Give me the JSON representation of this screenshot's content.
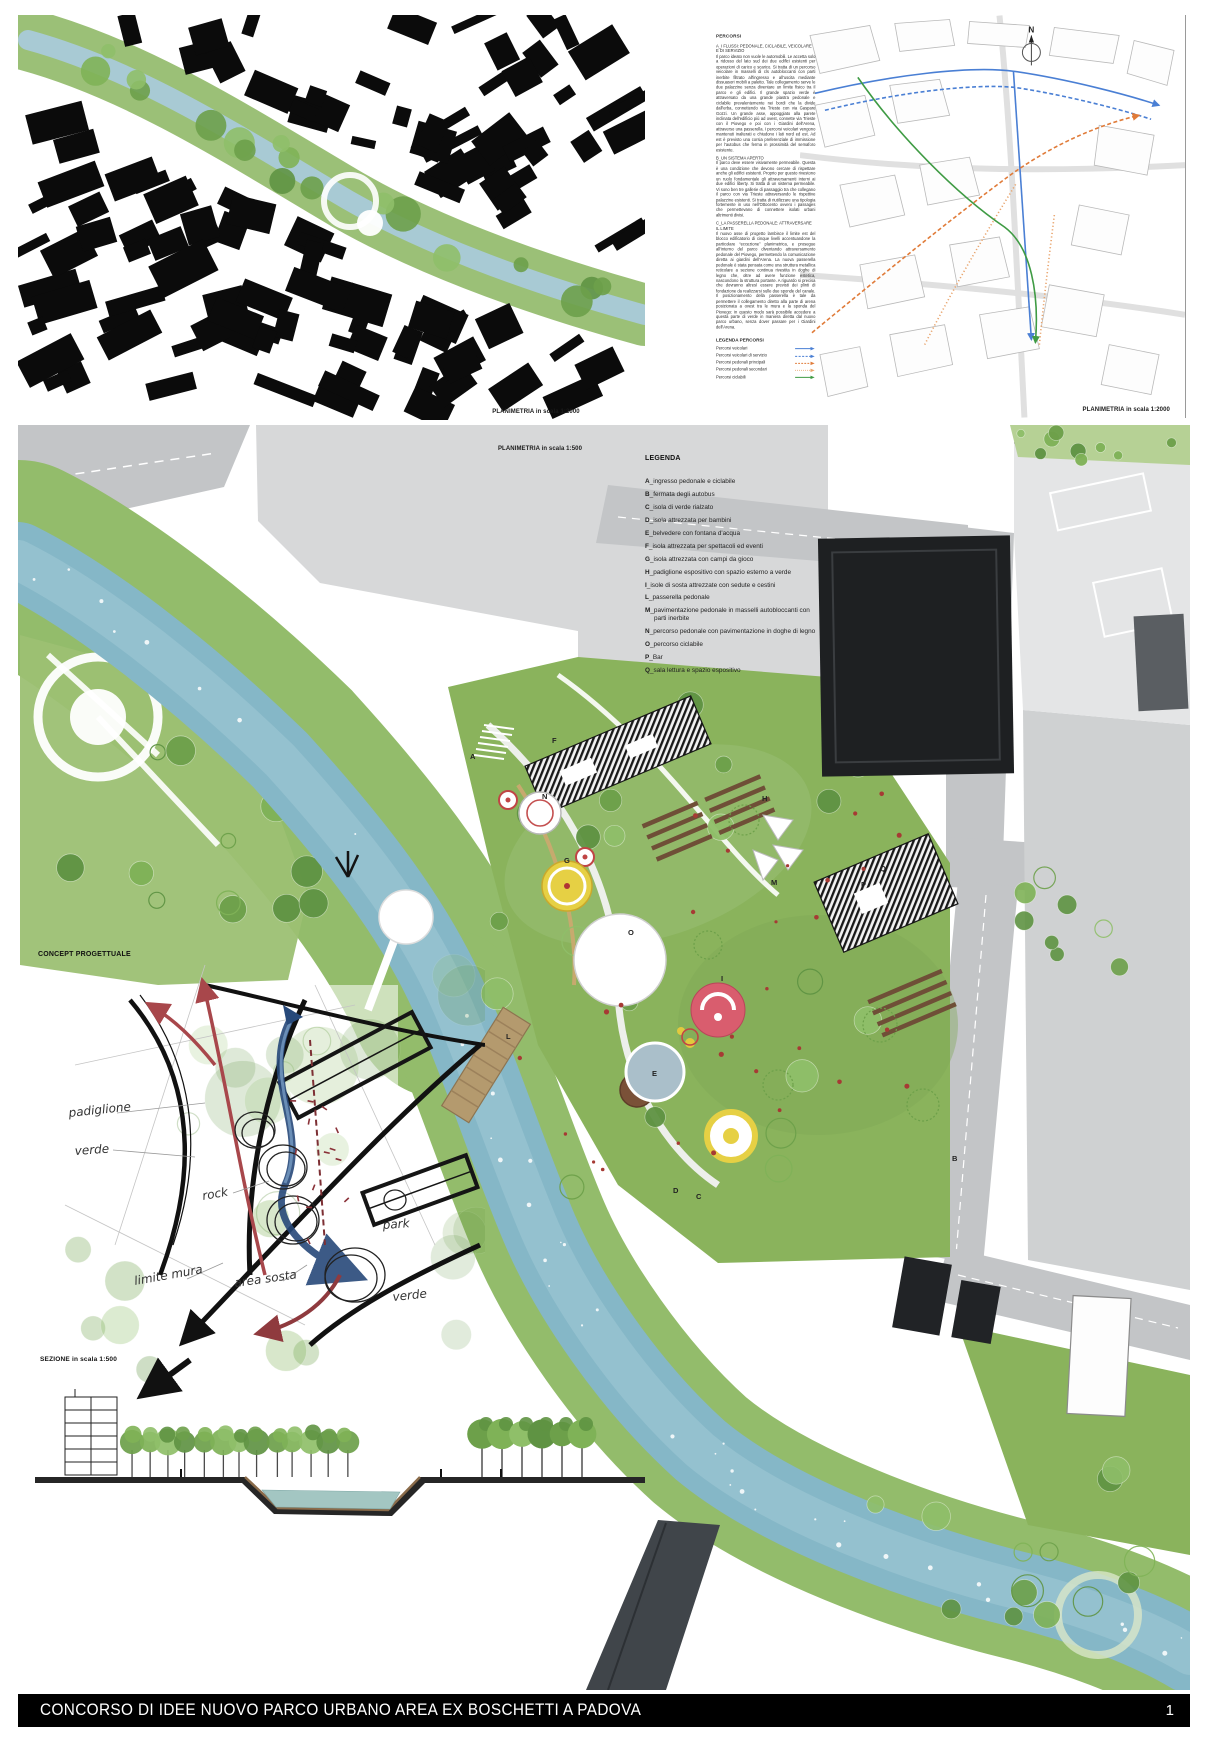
{
  "board": {
    "title": "CONCORSO DI IDEE NUOVO  PARCO URBANO AREA EX BOSCHETTI A  PADOVA",
    "page_number": "1"
  },
  "top_left_map": {
    "caption": "PLANIMETRIA in scala 1:2000"
  },
  "top_right_map": {
    "caption": "PLANIMETRIA in scala 1:2000",
    "north_label": "N"
  },
  "percorsi": {
    "title": "PERCORSI",
    "sections": [
      {
        "heading": "A_I FLUSSI: PEDONALE, CICLABILE, VEICOLARE E DI SERVIZIO",
        "body": "Il parco ideato non vuole le automobili. Le accetta solo a ridosso del lato sud dei due edifici esistenti per operazioni di carico e scarico. Si tratta di un percorso veicolare in masselli di cls autobloccanti con parti inerbite filtrato all'ingresso e all'uscita mediante dissuasori mobili a paletto. Tale collegamento serve le due palazzine senza diventare un limite fisico tra il parco e gli edifici. Il grande spazio verde è attraversato da una grande piastra pedonale e ciclabile prevalentemente nei bordi che la divide dall'erba, connettendo via Trieste con via Gaspare Gozzi. Un grande asse, appoggiato alla parete inclinata dell'edificio più ad ovest, connette via Trieste con il Piovego e poi con i Giardini dell'Arena, attraverso una passerella. I percorsi veicolari vengono mantenuti inalterati e chiudono i lati nord ed est. Ad est è previsto una corsia preferenziale di immissione per l'autobus che ferma in prossimità del semaforo esistente."
      },
      {
        "heading": "B_UN SISTEMA APERTO",
        "body": "Il parco deve essere visivamente permeabile. Questa è una condizione che devono cercare di rispettare anche gli edifici esistenti. Proprio per questo rivestono un ruolo fondamentale gli attraversamenti interni ai due edifici liberty. Si tratta di un sistema permeabile. Vi sono ben tre gallerie di passaggio tra che collegano il parco con via Trieste attraversando le rispettive palazzine esistenti. Si tratta di riutilizzare una tipologia fortemente in uso nell'Ottocento ovvero i passages che permettevano di connettere isolati urbani altrimenti divisi."
      },
      {
        "heading": "C_LA PASSERELLA PEDONALE: ATTRAVERSARE IL LIMITE",
        "body": "Il nuovo asse di progetto lambisce il limite est del blocco edificatorio di cinque livelli accentuandone la particolare “eccezione” planimetrica, e prosegue all'interno del parco diventando attraversamento pedonale del Piovego, permettendo la comunicazione diretta ai giardini dell'Arena. La nuova passerella pedonale è stata pensata come una struttura metallica reticolare a sezione continua rivestita in doghe di legno che, oltre ad avere funzione estetica, nascondono la struttura portante. A riguardo si precisa che dovranno altresì essere previsti dei plinti di fondazione da realizzarsi sulle due sponde del canale. Il posizionamento della passerella è tale da permettere il collegamento diretto alla parte di arena posizionata a ovest tra le mura e la sponda del Piovego: in questo modo sarà possibile accedere a questa parte di verde in maniera diretta dal nuovo parco urbano, senza dover passare per i Giardini dell'Arena."
      }
    ],
    "legend": {
      "title": "LEGENDA PERCORSI",
      "items": [
        {
          "label": "Percorsi veicolari",
          "color": "#4a7fd4",
          "dash": ""
        },
        {
          "label": "Percorsi veicolari di servizio",
          "color": "#4a7fd4",
          "dash": "3 2"
        },
        {
          "label": "Percorsi pedonali principali",
          "color": "#e07b39",
          "dash": "2.6 1.8"
        },
        {
          "label": "Percorsi pedonali secondari",
          "color": "#e8a36b",
          "dash": "1.1 1.8"
        },
        {
          "label": "Percorsi ciclabili",
          "color": "#3f9b44",
          "dash": ""
        }
      ]
    }
  },
  "master_plan": {
    "caption": "PLANIMETRIA in scala 1:500",
    "legend": {
      "title": "LEGENDA",
      "sep": "_",
      "items": [
        {
          "key": "A",
          "label": "ingresso pedonale e ciclabile"
        },
        {
          "key": "B",
          "label": "fermata degli autobus"
        },
        {
          "key": "C",
          "label": "isola di verde rialzato"
        },
        {
          "key": "D",
          "label": "isola attrezzata per bambini"
        },
        {
          "key": "E",
          "label": "belvedere con fontana d'acqua"
        },
        {
          "key": "F",
          "label": "isola attrezzata per spettacoli ed eventi"
        },
        {
          "key": "G",
          "label": "isola attrezzata con campi da gioco"
        },
        {
          "key": "H",
          "label": "padiglione espositivo con spazio esterno a verde"
        },
        {
          "key": "I",
          "label": "isole di sosta attrezzate con sedute e cestini"
        },
        {
          "key": "L",
          "label": "passerella pedonale"
        },
        {
          "key": "M",
          "label": "pavimentazione pedonale in masselli autobloccanti con parti inerbite"
        },
        {
          "key": "N",
          "label": "percorso pedonale con pavimentazione in doghe di legno"
        },
        {
          "key": "O",
          "label": "percorso ciclabile"
        },
        {
          "key": "P",
          "label": "Bar"
        },
        {
          "key": "Q",
          "label": "sala lettura e spazio espositivo"
        }
      ]
    }
  },
  "concept": {
    "title": "CONCEPT PROGETTUALE",
    "annotations": [
      {
        "text": "padiglione"
      },
      {
        "text": "verde"
      },
      {
        "text": "rock"
      },
      {
        "text": "verde"
      },
      {
        "text": "park"
      },
      {
        "text": "limite mura"
      },
      {
        "text": "area sosta"
      }
    ]
  },
  "section_view": {
    "title": "SEZIONE in scala 1:500"
  },
  "colors": {
    "water": "#85b7c7",
    "park_green": "#8ab35c",
    "road_gray": "#c3c5c7",
    "building_dark": "#1e2022"
  }
}
